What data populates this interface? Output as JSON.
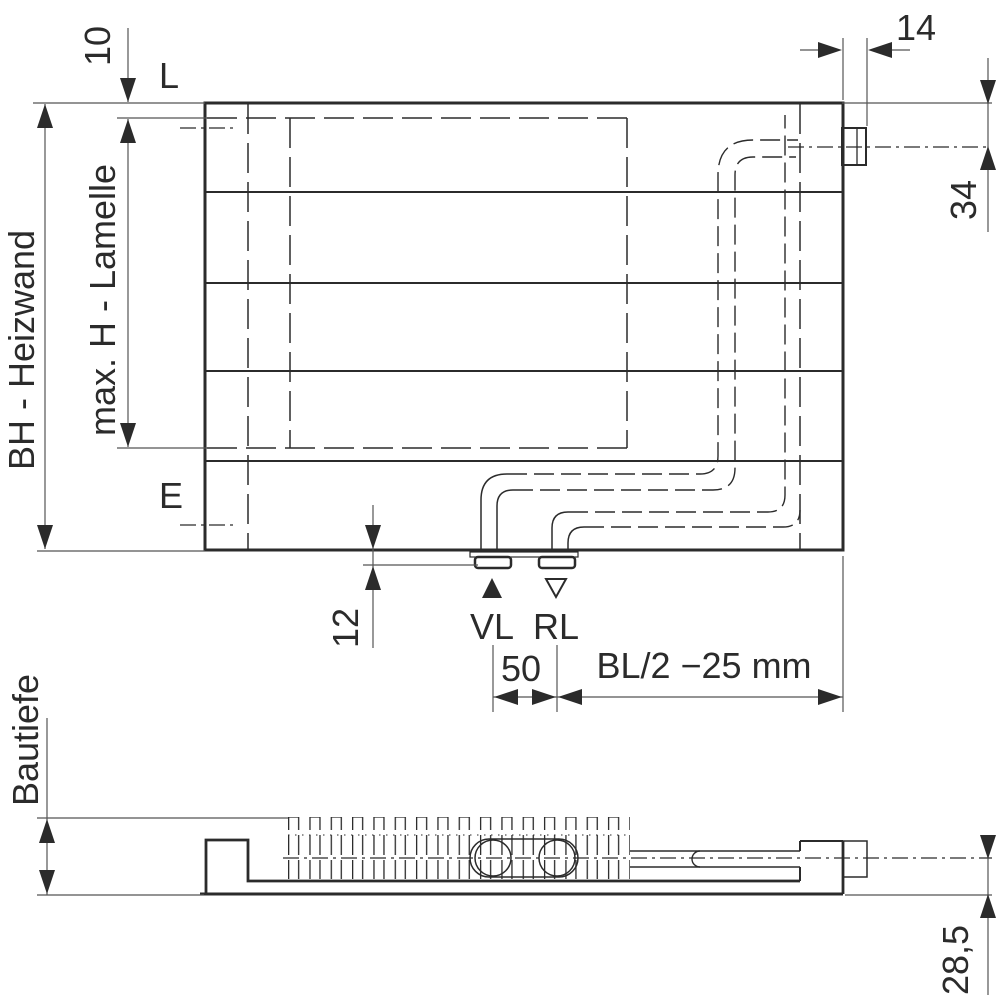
{
  "colors": {
    "ink": "#2b2b2b",
    "thin_line": "#555555",
    "background": "#ffffff"
  },
  "front": {
    "label_l": "L",
    "label_e": "E",
    "label_supply": "VL",
    "label_return": "RL",
    "dim_top_offset": "10",
    "dim_build_height": "BH - Heizwand",
    "dim_lamella_height": "max. H - Lamelle",
    "dim_connector_width": "14",
    "dim_connector_offset": "34",
    "dim_bottom_offset": "12",
    "dim_connection_spacing": "50",
    "dim_connection_position": "BL/2 −25 mm"
  },
  "side": {
    "dim_depth": "Bautiefe",
    "dim_connector_height": "28,5"
  }
}
